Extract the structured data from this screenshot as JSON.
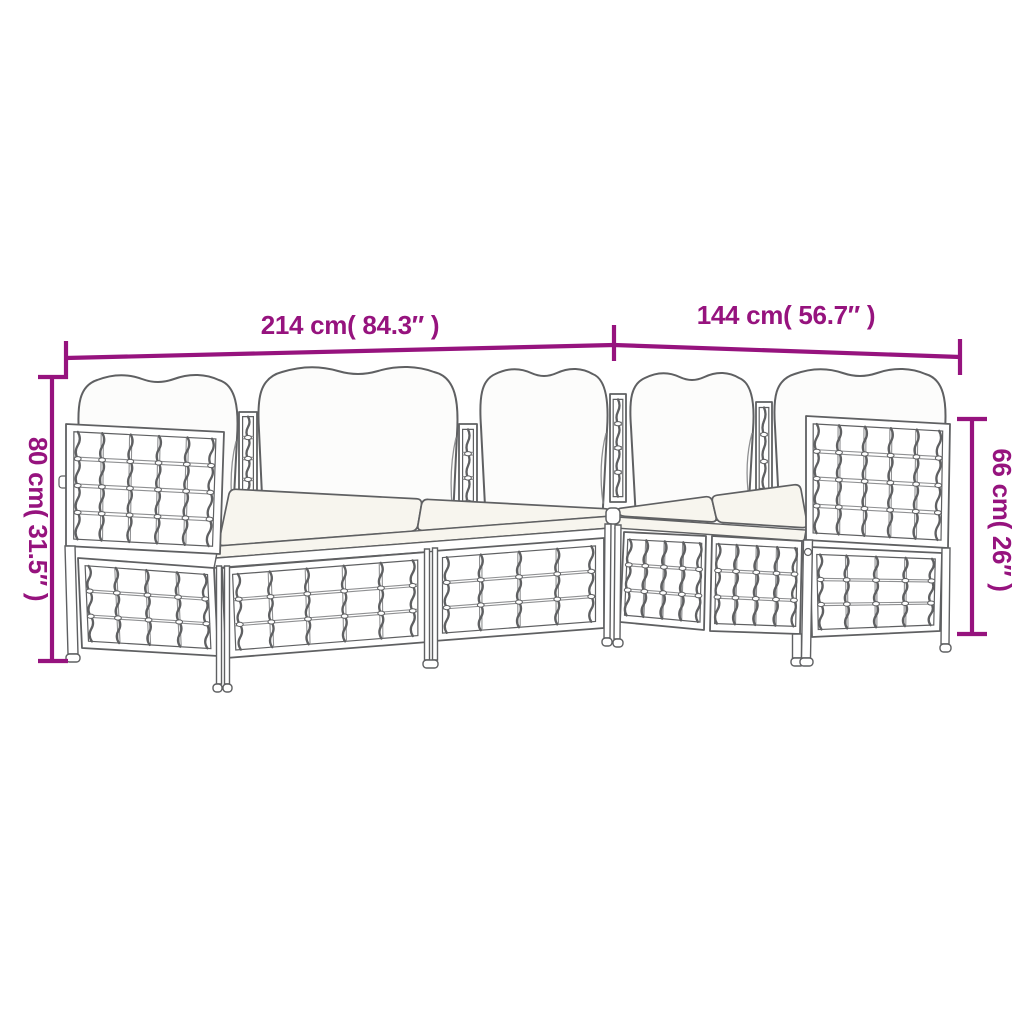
{
  "page": {
    "background": "#ffffff"
  },
  "diagram": {
    "subject": "modular-poly-rattan-garden-sofa-set-line-drawing",
    "accent_color": "#96137E",
    "line_color": "#5F6062",
    "line_color_light": "#8F9092",
    "panel_fill": "#FFFFFF",
    "cushion_fill": "#FCFCFB",
    "seat_fill": "#F7F5EE",
    "dimensions": {
      "top_left": {
        "label": "214 cm( 84.3″ )"
      },
      "top_right": {
        "label": "144 cm( 56.7″ )"
      },
      "left": {
        "label": "80 cm( 31.5″ )"
      },
      "right": {
        "label": "66 cm( 26″ )"
      }
    }
  }
}
